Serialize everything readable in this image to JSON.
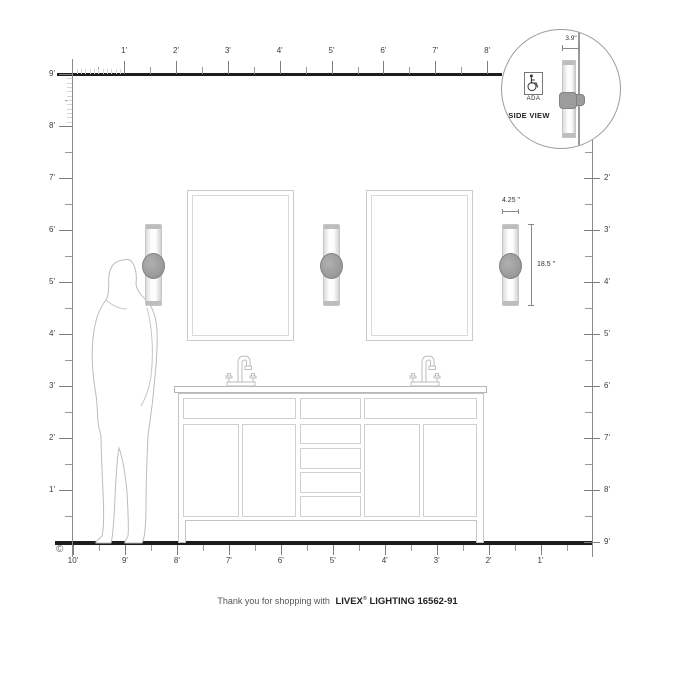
{
  "rulers": {
    "top": {
      "labels": [
        "1'",
        "2'",
        "3'",
        "4'",
        "5'",
        "6'",
        "7'",
        "8'"
      ]
    },
    "left": {
      "labels": [
        "9'",
        "8'",
        "7'",
        "6'",
        "5'",
        "4'",
        "3'",
        "2'",
        "1'"
      ]
    },
    "right": {
      "labels": [
        "2'",
        "3'",
        "4'",
        "5'",
        "6'",
        "7'",
        "8'",
        "9'"
      ]
    },
    "bottom": {
      "labels": [
        "10'",
        "9'",
        "8'",
        "7'",
        "6'",
        "5'",
        "4'",
        "3'",
        "2'",
        "1'"
      ]
    }
  },
  "inset": {
    "side_view_label": "SIDE VIEW",
    "ada_label": "ADA",
    "depth_dim": "3.9\""
  },
  "fixture_dims": {
    "width": "4.25 \"",
    "height": "18.5 \""
  },
  "footer": {
    "prefix": "Thank you for shopping with",
    "brand": "LIVEX",
    "reg": "®",
    "suffix": "LIGHTING 16562-91"
  },
  "copyright": "©",
  "colors": {
    "wall_floor_line": "#1d1d1d",
    "ruler": "#8a8a8a",
    "outline_gray": "#c6c6c6",
    "sconce_band": "#9c9c9c"
  }
}
